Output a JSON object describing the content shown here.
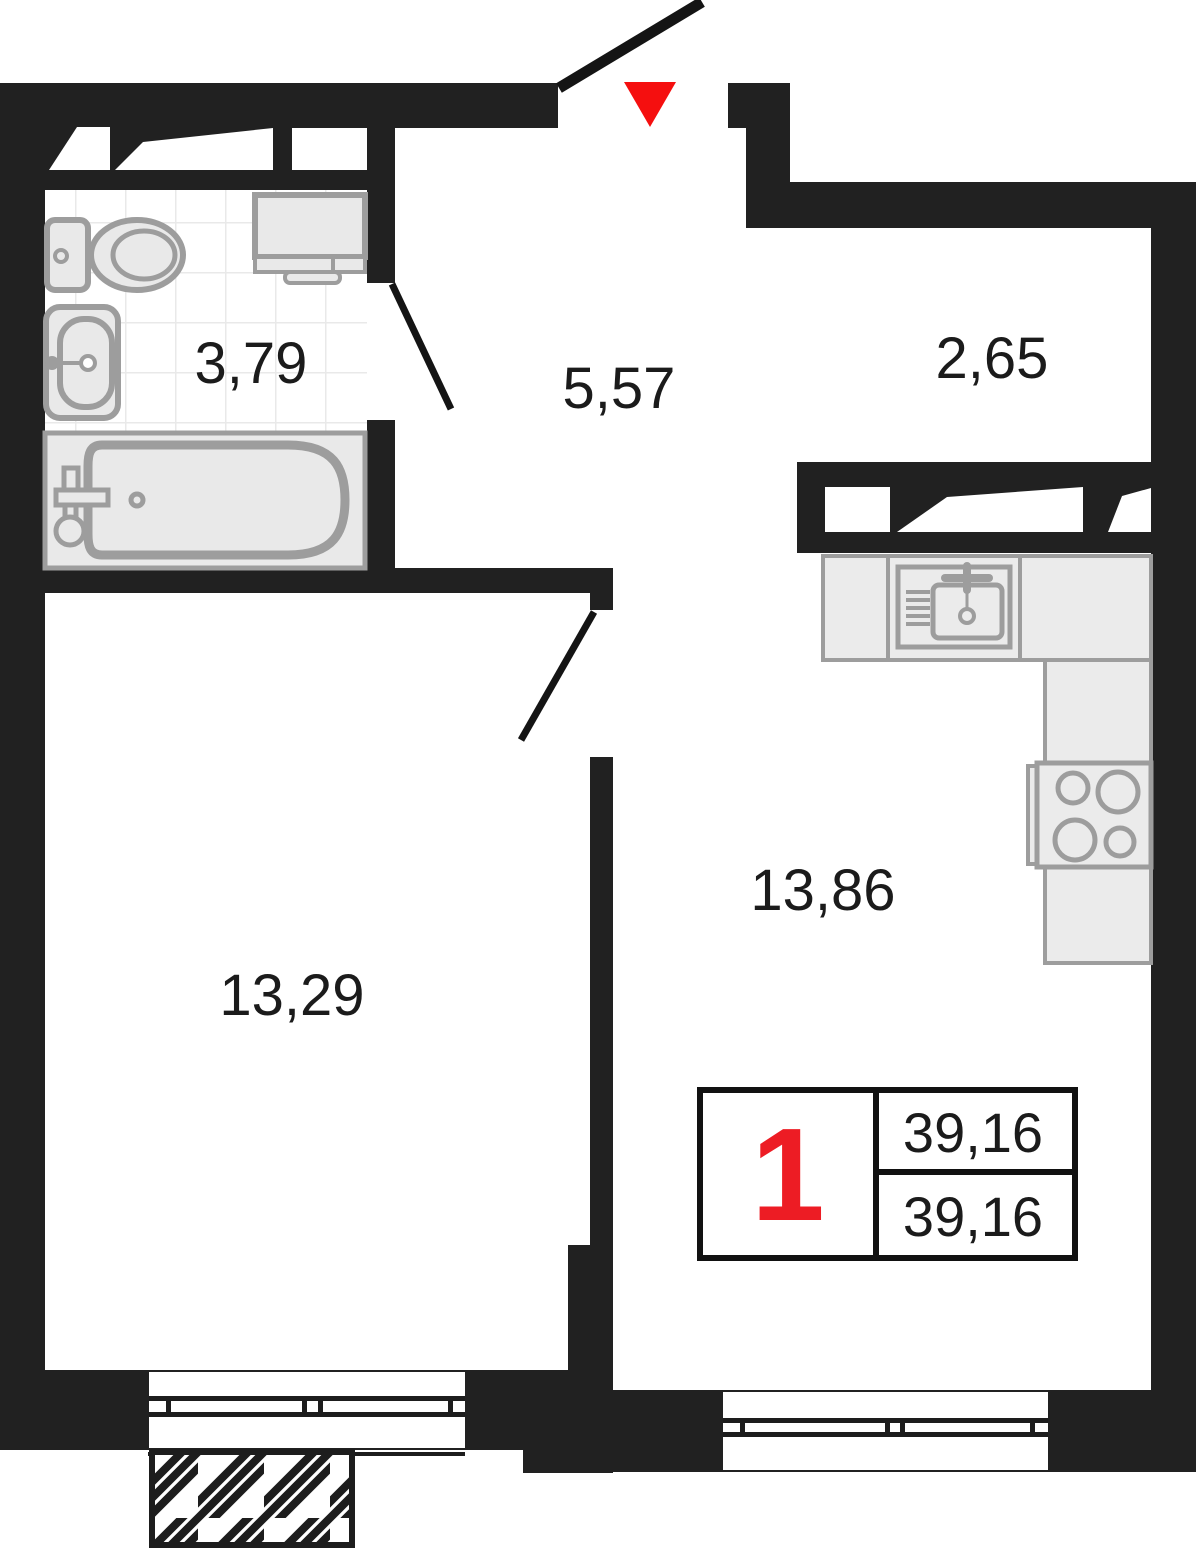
{
  "plan": {
    "type": "apartment-floor-plan",
    "rooms": [
      {
        "name": "bathroom",
        "area": "3,79"
      },
      {
        "name": "hallway",
        "area": "5,57"
      },
      {
        "name": "loggia",
        "area": "2,65"
      },
      {
        "name": "kitchen-living-room",
        "area": "13,86"
      },
      {
        "name": "room",
        "area": "13,29"
      }
    ],
    "stamp": {
      "rooms_count": "1",
      "total_area": "39,16",
      "living_area": "39,16"
    },
    "colors": {
      "wall": "#212121",
      "entry_marker_red": "#f50f0f",
      "stamp_number_red": "#ed1c24",
      "fixture_fill": "#e9e9e9",
      "fixture_stroke": "#9d9d9d",
      "frame_line": "#141414",
      "tile_line": "#e9e9e9",
      "text": "#1b1b1b"
    }
  }
}
